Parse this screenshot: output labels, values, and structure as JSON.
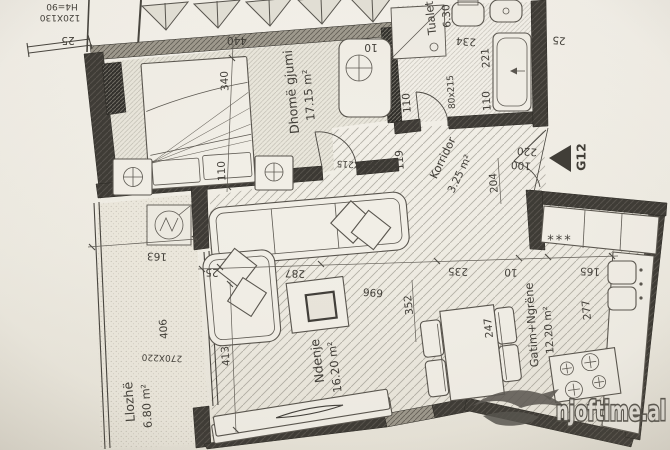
{
  "plan": {
    "unit_label": "G12",
    "watermark": "njoftime.al",
    "rooms": {
      "bedroom": {
        "name": "Dhomë gjumi",
        "area": "17.15 m²"
      },
      "toilet": {
        "name": "Tualet",
        "area": "6.30"
      },
      "corridor": {
        "name": "Korridor",
        "area": "3.25 m²"
      },
      "living": {
        "name": "Ndenje",
        "area": "16.20 m²"
      },
      "kitchen": {
        "name": "Gatim+Ngrëne",
        "area": "12.20 m²"
      },
      "loggia": {
        "name": "Llozhë",
        "area": "6.80 m²"
      }
    },
    "fixtures": {
      "fridge_mark": "***"
    },
    "dims": {
      "parapet_note": "H4=90",
      "bedroom_window": "120X130",
      "wall_tl": "25",
      "bedroom_width": "440",
      "bed_length": "340",
      "bed_width": "110",
      "niche": "10",
      "toilet_depth": "234",
      "tub_length": "221",
      "toilet_door": "80x215",
      "toilet_left": "110",
      "toilet_right": "110",
      "wall_tr": "25",
      "bedroom_door": "190X215",
      "corridor_width": "119",
      "corridor_len": "204",
      "entry_a": "220",
      "entry_b": "100",
      "loggia_top": "163",
      "wall_living": "25",
      "sofa_span": "287",
      "living_span": "696",
      "living_depth": "352",
      "dining_span": "235",
      "gap": "10",
      "kitchen_span": "165",
      "living_left": "413",
      "loggia_len": "406",
      "loggia_window": "270X220",
      "table_len": "247",
      "kitchen_depth": "277"
    },
    "colors": {
      "wall": "#3b3833",
      "paper": "#f0ece3",
      "ink": "#3e3b35"
    }
  }
}
